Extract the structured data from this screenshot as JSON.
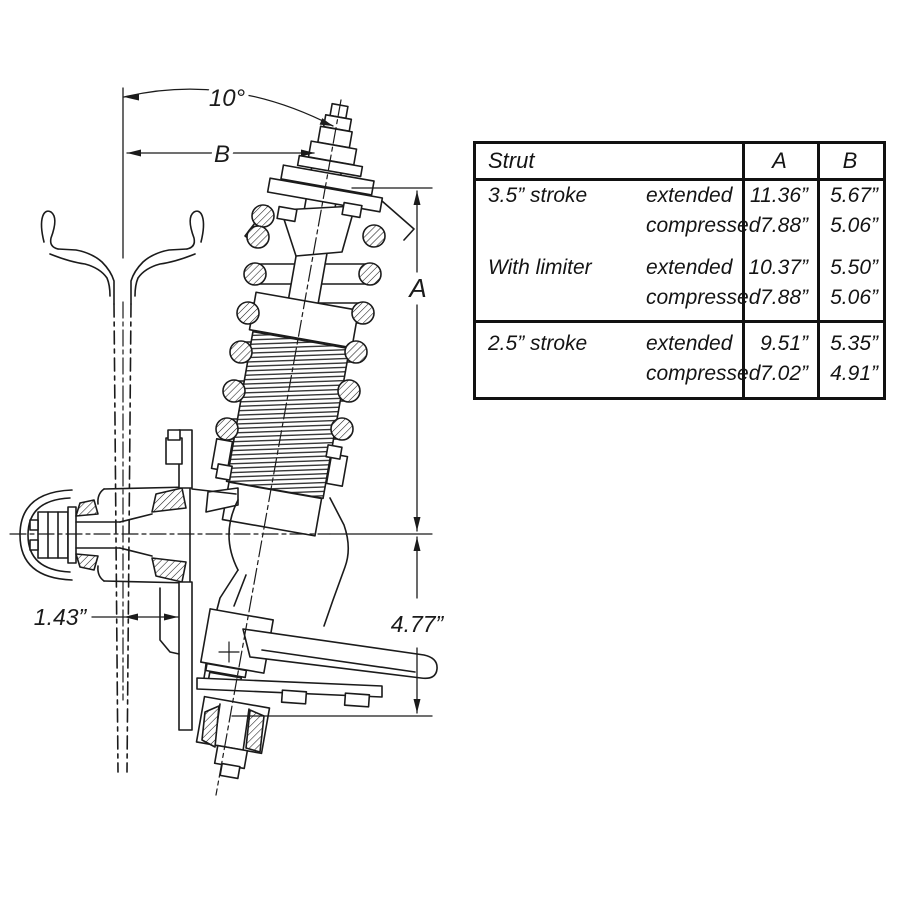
{
  "drawing": {
    "line_color": "#1b1b1b",
    "background": "#ffffff",
    "annotations": {
      "angle": "10°",
      "dim_b": "B",
      "dim_a": "A",
      "dim_ball_joint": "4.77”",
      "dim_offset": "1.43”"
    }
  },
  "table": {
    "header": {
      "col_main": "Strut",
      "col_a": "A",
      "col_b": "B"
    },
    "sections": [
      {
        "rows": [
          {
            "label": "3.5” stroke",
            "state": "extended",
            "a": "11.36”",
            "b": "5.67”"
          },
          {
            "label": "",
            "state": "compressed",
            "a": "7.88”",
            "b": "5.06”"
          },
          {
            "label": "With limiter",
            "state": "extended",
            "a": "10.37”",
            "b": "5.50”"
          },
          {
            "label": "",
            "state": "compressed",
            "a": "7.88”",
            "b": "5.06”"
          }
        ]
      },
      {
        "rows": [
          {
            "label": "2.5” stroke",
            "state": "extended",
            "a": "9.51”",
            "b": "5.35”"
          },
          {
            "label": "",
            "state": "compressed",
            "a": "7.02”",
            "b": "4.91”"
          }
        ]
      }
    ]
  }
}
